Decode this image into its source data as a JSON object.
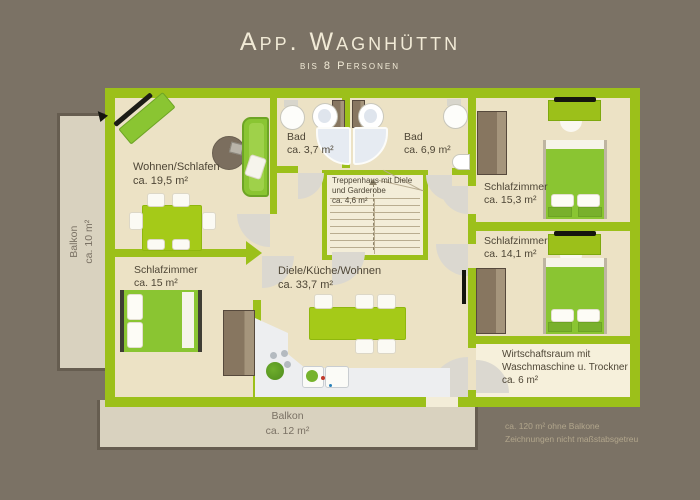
{
  "header": {
    "title": "App. Wagnhüttn",
    "subtitle": "bis 8 Personen"
  },
  "rooms": [
    {
      "name": "Wohnen/Schlafen",
      "area": "ca. 19,5 m²"
    },
    {
      "name": "Bad",
      "area": "ca. 3,7 m²"
    },
    {
      "name": "Bad",
      "area": "ca. 6,9 m²"
    },
    {
      "name": "Treppenhaus mit Diele und Garderobe",
      "area": "ca. 4,6 m²"
    },
    {
      "name": "Schlafzimmer",
      "area": "ca. 15,3 m²"
    },
    {
      "name": "Schlafzimmer",
      "area": "ca. 14,1 m²"
    },
    {
      "name": "Schlafzimmer",
      "area": "ca. 15 m²"
    },
    {
      "name": "Diele/Küche/Wohnen",
      "area": "ca. 33,7 m²"
    },
    {
      "name": "Wirtschaftsraum mit Waschmaschine u. Trockner",
      "area": "ca. 6 m²"
    },
    {
      "name": "Balkon",
      "area": "ca. 10 m²"
    },
    {
      "name": "Balkon",
      "area": "ca. 12 m²"
    }
  ],
  "footnote": {
    "line1": "ca. 120 m² ohne Balkone",
    "line2": "Zeichnungen nicht maßstabsgetreu"
  },
  "colors": {
    "background": "#7b7265",
    "wall_green": "#9cc01a",
    "floor": "#ece2c5",
    "balcony": "#d9d2bf",
    "furniture_green": "#8ac532",
    "wood_brown": "#877660",
    "label_text": "#4e4636",
    "title_text": "#f1ead6"
  }
}
